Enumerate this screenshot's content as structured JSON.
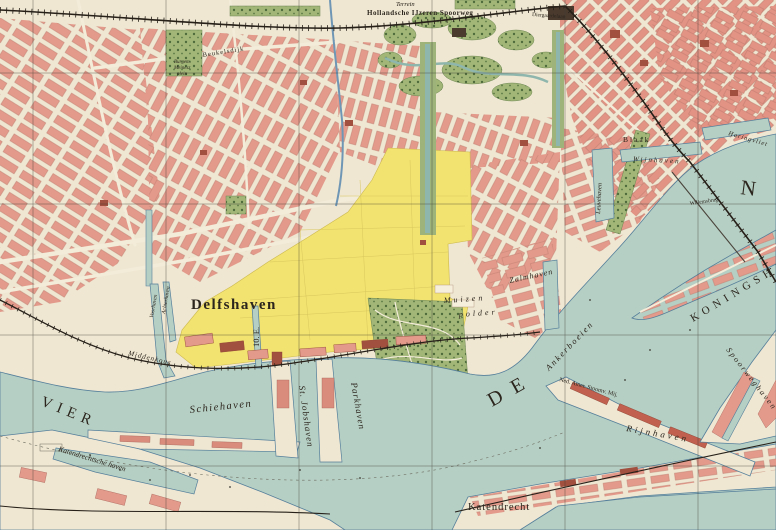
{
  "map": {
    "sheet_code": "10. E.",
    "labels": {
      "delfshaven": "Delfshaven",
      "schiehaven": "Schiehaven",
      "st_jobshaven": "St. Jobshaven",
      "parkhaven": "Parkhaven",
      "katendrechtsche_haven": "Katendrechtsche haven",
      "katendrecht": "Katendrecht",
      "rijnhaven": "Rijnhaven",
      "zalmhaven": "Zalmhaven",
      "koningshaven": "KONINGSHAVEN",
      "spoorweghaven": "Spoorweghaven",
      "leuvehaven": "Leuvehaven",
      "wijnhaven": "Wijnhaven",
      "haringvliet": "Haringvliet",
      "blaak": "Blaak",
      "willemsbrug": "Willemsbrug",
      "ankerboeien": "Ankerboeien",
      "muizenpolder_line1": "Muizen",
      "muizenpolder_line2": "polder",
      "ned_amer_stoomv": "Ned. Amer. Stoomv. Mij.",
      "hollandsche_spoorweg": "Hollandsche IJzeren Spoorweg",
      "terrein": "Terrein",
      "diergaardelaan": "Diergaardelaan",
      "beukelsdijk": "Beukelsdijk",
      "burgemeester_plein_1": "Burgem.",
      "burgemeester_plein_2": "Meinesz",
      "burgemeester_plein_3": "plein",
      "middenkous": "Middenkous",
      "voorhaven": "Voorhaven",
      "achterhaven": "Achterhaven",
      "river_fragment_west": "VIER",
      "river_fragment_mid": "DE",
      "river_fragment_east": "N"
    },
    "colors": {
      "water": "#b6cfc4",
      "land": "#efe7d2",
      "block": "#e49a8b",
      "blockdark": "#a14f3e",
      "yellow": "#f2e370",
      "park": "#a2b678",
      "tree": "#4e6b3c",
      "rail": "#262019",
      "grid": "#3c3a34",
      "canal": "#8fb6ac",
      "quay": "#557f9b",
      "road": "#f3ecd9",
      "text": "#2b251d"
    }
  }
}
